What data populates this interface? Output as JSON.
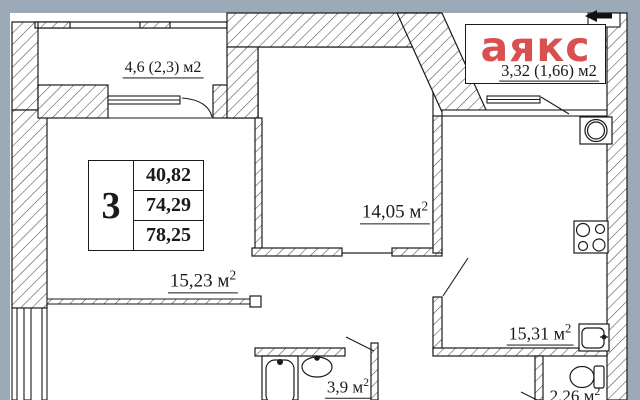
{
  "colors": {
    "background": "#9caab7",
    "paper": "#ffffff",
    "line": "#1a1a1a",
    "logo_red": "#d85050"
  },
  "logo": {
    "text": "аякс"
  },
  "info_table": {
    "rooms_count": "3",
    "areas": [
      "40,82",
      "74,29",
      "78,25"
    ]
  },
  "room_labels": [
    {
      "id": "balcony-top-left",
      "label": "4,6 (2,3) м2",
      "sup": ""
    },
    {
      "id": "balcony-top-right",
      "label": "3,32 (1,66) м2",
      "sup": ""
    },
    {
      "id": "living-room",
      "label": "15,23 м",
      "sup": "2"
    },
    {
      "id": "room-center",
      "label": "14,05 м",
      "sup": "2"
    },
    {
      "id": "kitchen",
      "label": "15,31 м",
      "sup": "2"
    },
    {
      "id": "bathroom",
      "label": "3,9 м",
      "sup": "2"
    },
    {
      "id": "wc",
      "label": "2,26 м",
      "sup": "2"
    }
  ]
}
